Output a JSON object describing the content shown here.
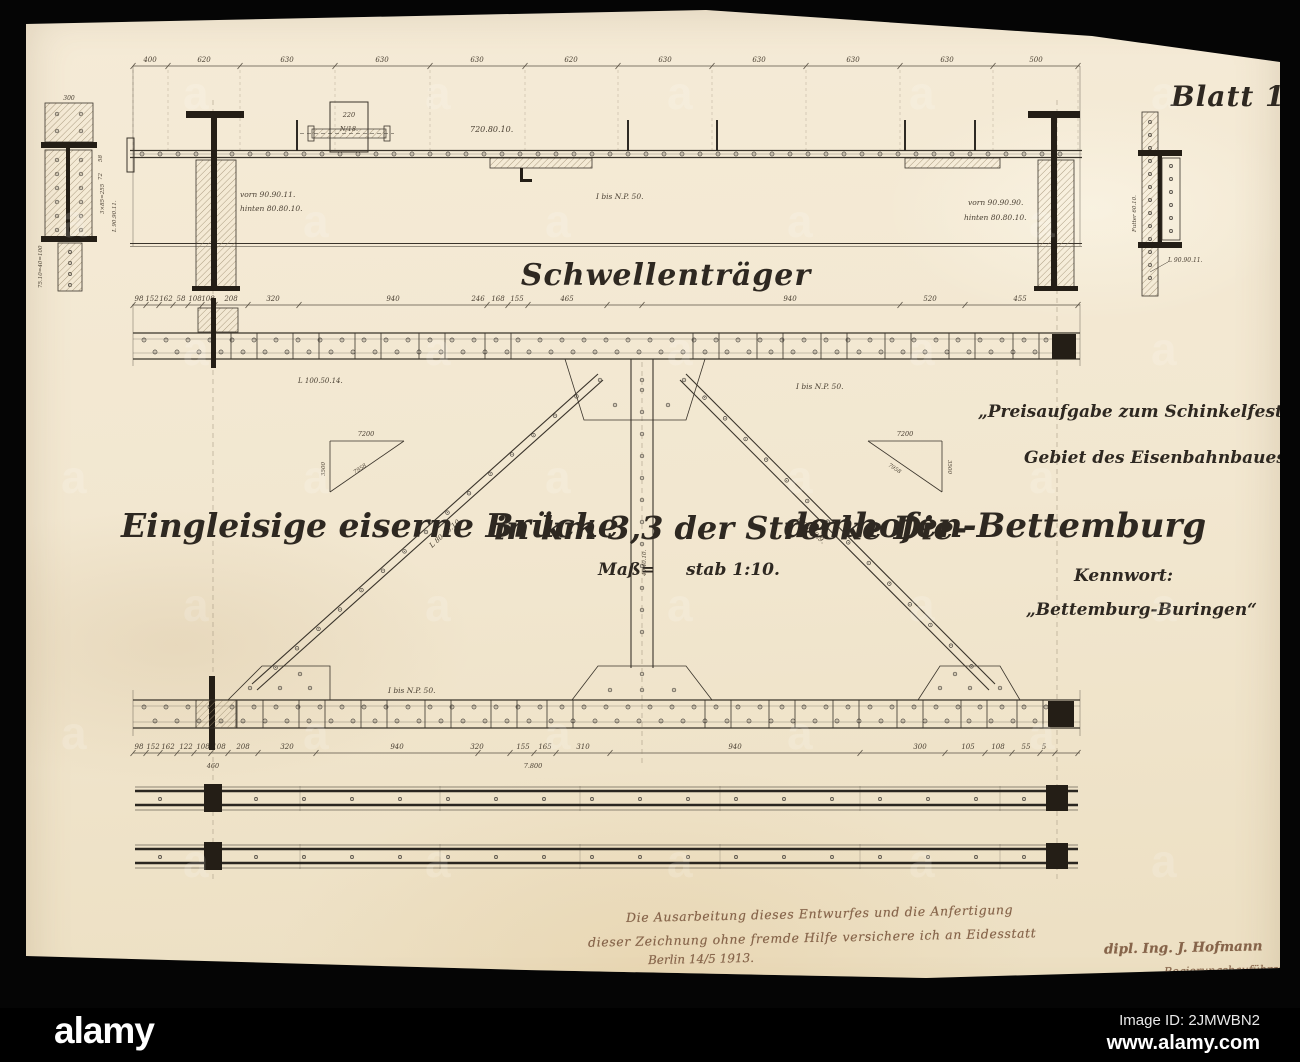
{
  "stock_bar": {
    "brand": "alamy",
    "image_id": "Image ID: 2JMWBN2",
    "url": "www.alamy.com",
    "watermark_glyph": "a"
  },
  "sheet": {
    "number": "Blatt 10.",
    "girder_title": "Schwellenträger",
    "main_title_part1": "Eingleisige eiserne Brücke",
    "main_title_part2": "in km 3,3 der Strecke Die-",
    "main_title_part3": "denhofen-Bettemburg",
    "scale_part1": "Maß=",
    "scale_part2": "stab 1:10.",
    "competition_line1": "„Preisaufgabe zum Schinkelfest 1913.",
    "competition_line2": "Gebiet des Eisenbahnbaues.“",
    "keyword_label": "Kennwort:",
    "keyword_value": "„Bettemburg-Buringen“"
  },
  "handwriting": {
    "line1": "Die Ausarbeitung dieses Entwurfes und die Anfertigung",
    "line2": "dieser Zeichnung ohne fremde Hilfe versichere ich an Eidesstatt",
    "place_date": "Berlin 14/5 1913.",
    "signature": "dipl. Ing. J. Hofmann",
    "role": "Regierungsbauführer"
  },
  "labels": {
    "top_left_front": "vorn 90.90.11.",
    "top_left_back": "hinten 80.80.10.",
    "top_profile": "I bis N.P. 50.",
    "top_right_front": "vorn 90.90.90.",
    "top_right_back": "hinten 80.80.10.",
    "cover_plate": "720.80.10.",
    "box_width": "220",
    "box_profile": "N/18.",
    "chord_angle": "L 100.50.14.",
    "chord_profile": "I bis N.P. 50.",
    "diag_left": "L 80.80.10.",
    "diag_right": "L 90.90.9.",
    "post_note": "40.40.10.",
    "tri_left_top": "7200",
    "tri_left_side": "3500",
    "tri_left_hyp": "7958",
    "tri_right_top": "7200",
    "tri_right_side": "3500",
    "tri_right_hyp": "7958",
    "bottom_profile": "I bis N.P. 50.",
    "bottom_sub_left": "460",
    "bottom_sub_mid": "7.800",
    "detail_left_top": "300",
    "detail_left_d1": "3×85=255",
    "detail_left_d2": "L 90.90.11.",
    "detail_left_d3": "75.10=40=100",
    "detail_left_d4": "58",
    "detail_left_d5": "72",
    "detail_right_liner": "Futter 60.10.",
    "detail_right_angle": "L 90.90.11."
  },
  "dim_rows": [
    {
      "id": "dimA",
      "line_y": 66,
      "label_y": 62,
      "x0": 133,
      "x1": 1080,
      "drop_to": 150,
      "ticks": [
        133,
        168,
        240,
        335,
        430,
        525,
        618,
        712,
        806,
        900,
        993,
        1078
      ],
      "labels": [
        [
          150,
          "400"
        ],
        [
          204,
          "620"
        ],
        [
          287,
          "630"
        ],
        [
          382,
          "630"
        ],
        [
          477,
          "630"
        ],
        [
          571,
          "620"
        ],
        [
          665,
          "630"
        ],
        [
          759,
          "630"
        ],
        [
          853,
          "630"
        ],
        [
          947,
          "630"
        ],
        [
          1036,
          "500"
        ]
      ]
    },
    {
      "id": "dimB",
      "line_y": 305,
      "label_y": 301,
      "x0": 133,
      "x1": 1080,
      "drop_to": 0,
      "ticks": [
        133,
        146,
        159,
        173,
        188,
        202,
        215,
        248,
        299,
        487,
        508,
        528,
        607,
        642,
        900,
        965,
        1078
      ],
      "labels": [
        [
          139,
          "98"
        ],
        [
          152,
          "152"
        ],
        [
          166,
          "162"
        ],
        [
          181,
          "58"
        ],
        [
          195,
          "108"
        ],
        [
          208,
          "108"
        ],
        [
          231,
          "208"
        ],
        [
          273,
          "320"
        ],
        [
          393,
          "940"
        ],
        [
          478,
          "246"
        ],
        [
          498,
          "168"
        ],
        [
          517,
          "155"
        ],
        [
          567,
          "465"
        ],
        [
          790,
          "940"
        ],
        [
          930,
          "520"
        ],
        [
          1020,
          "455"
        ]
      ]
    },
    {
      "id": "dimE",
      "line_y": 753,
      "label_y": 749,
      "x0": 133,
      "x1": 1080,
      "drop_to": 0,
      "ticks": [
        133,
        146,
        160,
        177,
        194,
        211,
        228,
        258,
        316,
        478,
        510,
        534,
        556,
        610,
        860,
        945,
        985,
        1012,
        1040,
        1055,
        1078
      ],
      "labels": [
        [
          139,
          "98"
        ],
        [
          153,
          "152"
        ],
        [
          168,
          "162"
        ],
        [
          186,
          "122"
        ],
        [
          203,
          "108"
        ],
        [
          219,
          "108"
        ],
        [
          243,
          "208"
        ],
        [
          287,
          "320"
        ],
        [
          397,
          "940"
        ],
        [
          477,
          "320"
        ],
        [
          523,
          "155"
        ],
        [
          545,
          "165"
        ],
        [
          583,
          "310"
        ],
        [
          735,
          "940"
        ],
        [
          920,
          "300"
        ],
        [
          968,
          "105"
        ],
        [
          998,
          "108"
        ],
        [
          1026,
          "55"
        ],
        [
          1044,
          "5"
        ]
      ]
    }
  ]
}
